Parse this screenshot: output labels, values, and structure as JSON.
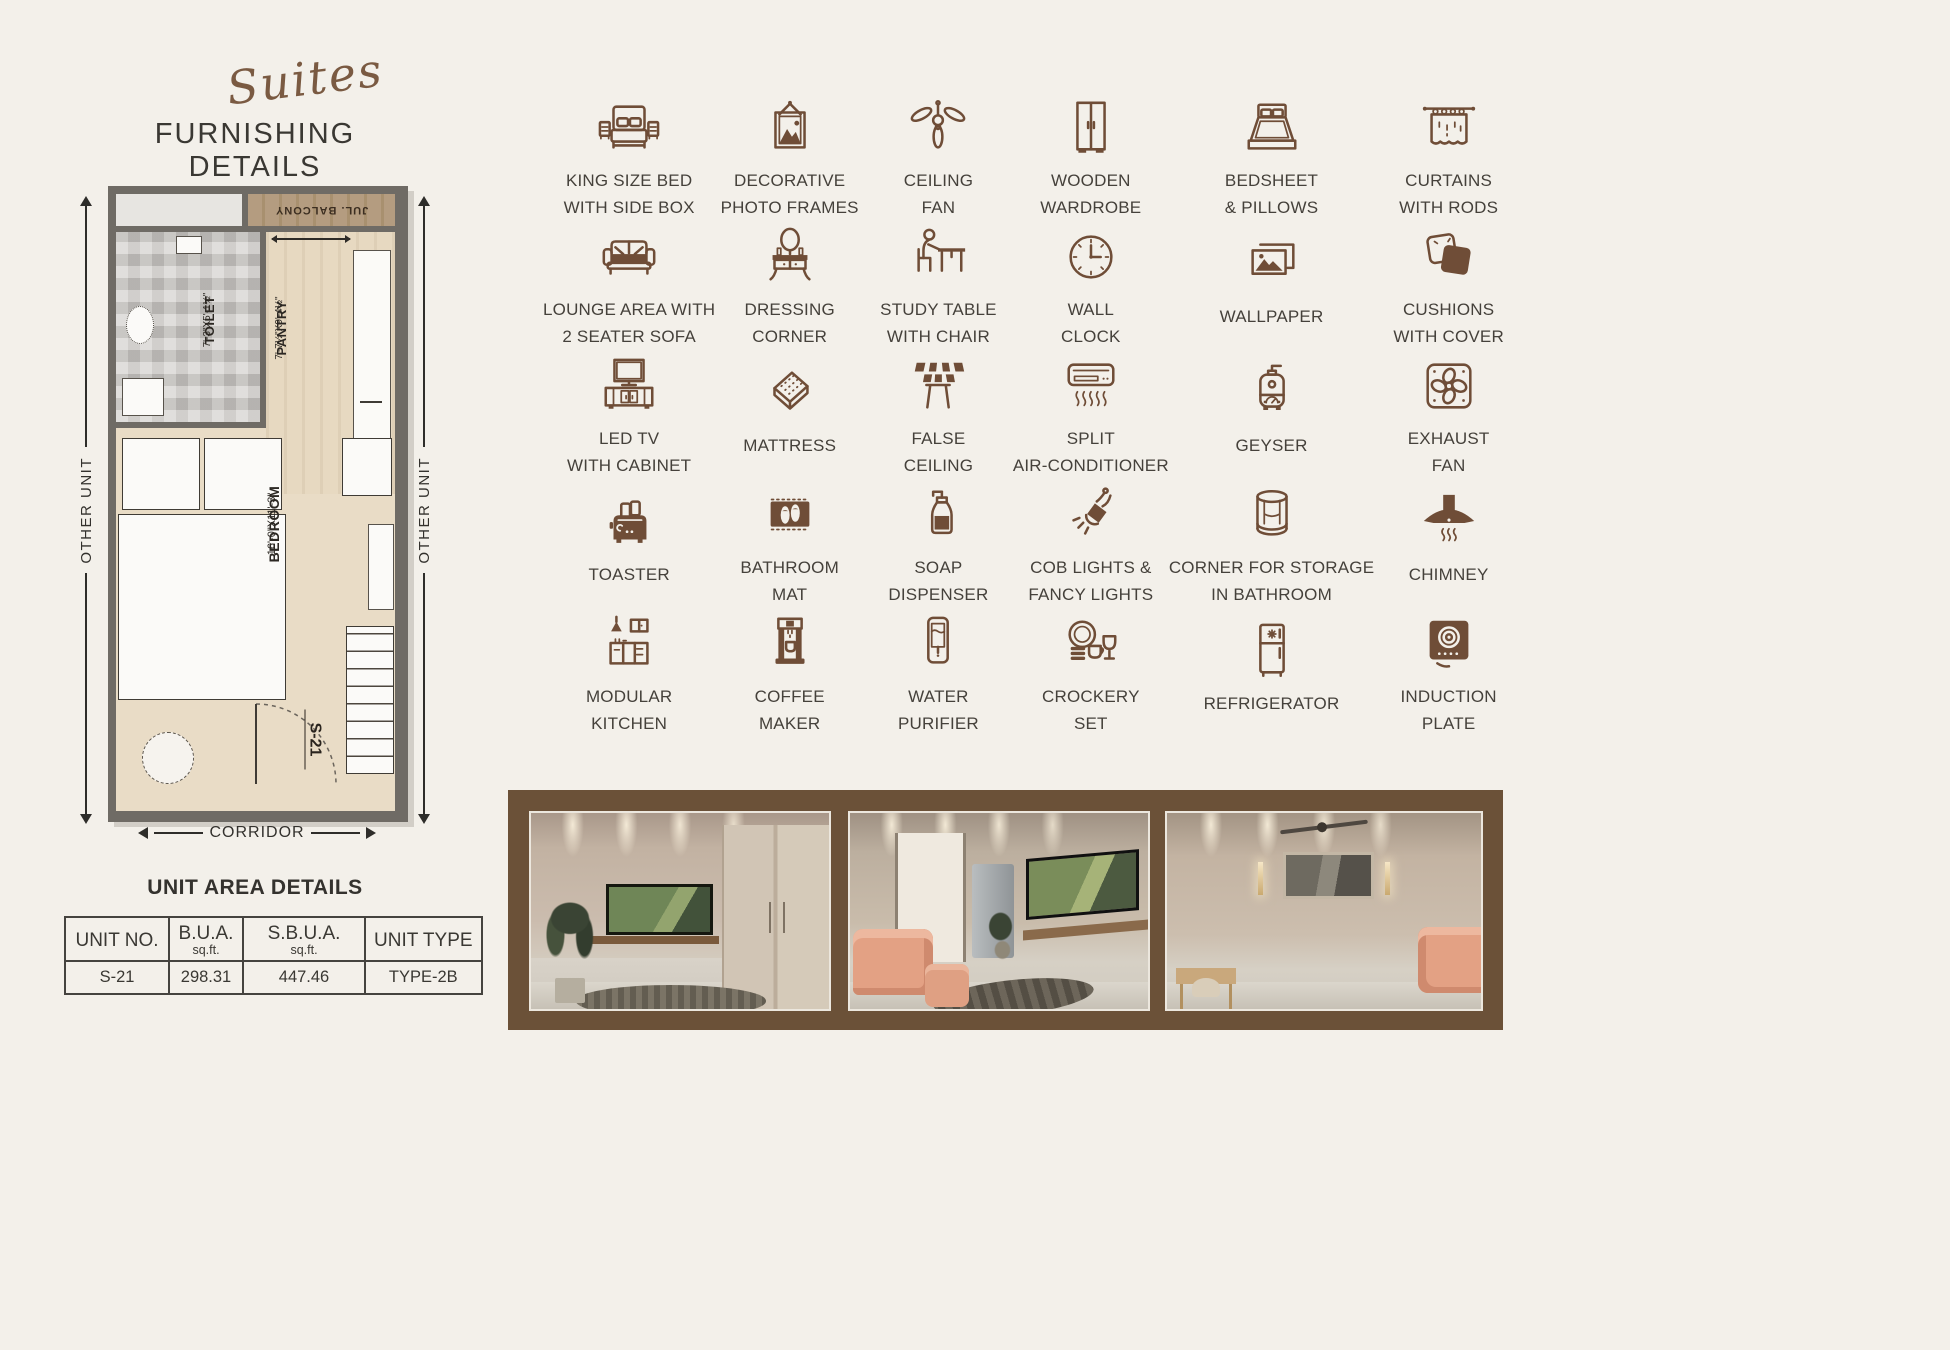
{
  "page": {
    "bg": "#f3f0ea",
    "accent_brown": "#6F4D37",
    "frame_brown": "#6b5138",
    "text_dark": "#3d3934"
  },
  "header": {
    "brand_script": "Suites",
    "title": "FURNISHING DETAILS"
  },
  "floor_plan": {
    "balcony_label": "JUL. BALCONY",
    "toilet_label": "TOILET",
    "toilet_dims": "7'-3\"X5'-1½\"",
    "pantry_label": "PANTRY",
    "pantry_dims": "7'-7½\"X9'-4½\"",
    "bedroom_label": "BEDROOM",
    "bedroom_dims": "16'-0\"X11'-3\"",
    "unit_label": "S-21",
    "left_side_label": "OTHER UNIT",
    "right_side_label": "OTHER UNIT",
    "bottom_label": "CORRIDOR"
  },
  "unit_area": {
    "title": "UNIT AREA DETAILS",
    "columns": [
      {
        "label": "UNIT NO.",
        "sub": ""
      },
      {
        "label": "B.U.A.",
        "sub": "sq.ft."
      },
      {
        "label": "S.B.U.A.",
        "sub": "sq.ft."
      },
      {
        "label": "UNIT TYPE",
        "sub": ""
      }
    ],
    "row": [
      "S-21",
      "298.31",
      "447.46",
      "TYPE-2B"
    ]
  },
  "icon_grid": {
    "items": [
      {
        "icon": "king-size-bed-icon",
        "line1": "KING SIZE BED",
        "line2": "WITH SIDE BOX"
      },
      {
        "icon": "photo-frames-icon",
        "line1": "DECORATIVE",
        "line2": "PHOTO FRAMES"
      },
      {
        "icon": "ceiling-fan-icon",
        "line1": "CEILING",
        "line2": "FAN"
      },
      {
        "icon": "wardrobe-icon",
        "line1": "WOODEN",
        "line2": "WARDROBE"
      },
      {
        "icon": "bedsheet-pillows-icon",
        "line1": "BEDSHEET",
        "line2": "& PILLOWS"
      },
      {
        "icon": "curtains-icon",
        "line1": "CURTAINS",
        "line2": "WITH RODS"
      },
      {
        "icon": "sofa-icon",
        "line1": "LOUNGE AREA WITH",
        "line2": "2 SEATER SOFA"
      },
      {
        "icon": "dressing-table-icon",
        "line1": "DRESSING",
        "line2": "CORNER"
      },
      {
        "icon": "study-table-icon",
        "line1": "STUDY TABLE",
        "line2": "WITH CHAIR"
      },
      {
        "icon": "wall-clock-icon",
        "line1": "WALL",
        "line2": "CLOCK"
      },
      {
        "icon": "wallpaper-icon",
        "line1": "WALLPAPER",
        "line2": ""
      },
      {
        "icon": "cushions-icon",
        "line1": "CUSHIONS",
        "line2": "WITH COVER"
      },
      {
        "icon": "led-tv-icon",
        "line1": "LED TV",
        "line2": "WITH CABINET"
      },
      {
        "icon": "mattress-icon",
        "line1": "MATTRESS",
        "line2": ""
      },
      {
        "icon": "false-ceiling-icon",
        "line1": "FALSE",
        "line2": "CEILING"
      },
      {
        "icon": "split-ac-icon",
        "line1": "SPLIT",
        "line2": "AIR-CONDITIONER"
      },
      {
        "icon": "geyser-icon",
        "line1": "GEYSER",
        "line2": ""
      },
      {
        "icon": "exhaust-fan-icon",
        "line1": "EXHAUST",
        "line2": "FAN"
      },
      {
        "icon": "toaster-icon",
        "line1": "TOASTER",
        "line2": ""
      },
      {
        "icon": "bathroom-mat-icon",
        "line1": "BATHROOM",
        "line2": "MAT"
      },
      {
        "icon": "soap-dispenser-icon",
        "line1": "SOAP",
        "line2": "DISPENSER"
      },
      {
        "icon": "cob-lights-icon",
        "line1": "COB LIGHTS &",
        "line2": "FANCY LIGHTS"
      },
      {
        "icon": "corner-storage-icon",
        "line1": "CORNER FOR STORAGE",
        "line2": "IN BATHROOM"
      },
      {
        "icon": "chimney-icon",
        "line1": "CHIMNEY",
        "line2": ""
      },
      {
        "icon": "modular-kitchen-icon",
        "line1": "MODULAR",
        "line2": "KITCHEN"
      },
      {
        "icon": "coffee-maker-icon",
        "line1": "COFFEE",
        "line2": "MAKER"
      },
      {
        "icon": "water-purifier-icon",
        "line1": "WATER",
        "line2": "PURIFIER"
      },
      {
        "icon": "crockery-set-icon",
        "line1": "CROCKERY",
        "line2": "SET"
      },
      {
        "icon": "refrigerator-icon",
        "line1": "REFRIGERATOR",
        "line2": ""
      },
      {
        "icon": "induction-plate-icon",
        "line1": "INDUCTION",
        "line2": "PLATE"
      }
    ]
  },
  "photos": [
    "interior-view-1",
    "interior-view-2",
    "interior-view-3"
  ]
}
